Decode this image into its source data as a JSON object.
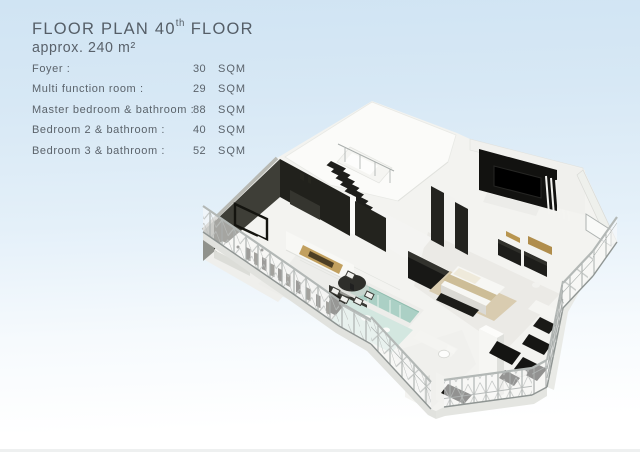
{
  "header": {
    "title_prefix": "FLOOR PLAN 40",
    "title_sup": "th",
    "title_suffix": " FLOOR",
    "subtitle": "approx. 240 m²"
  },
  "rooms": [
    {
      "label": "Foyer :",
      "value": "30",
      "unit": "SQM"
    },
    {
      "label": "Multi function room :",
      "value": "29",
      "unit": "SQM"
    },
    {
      "label": "Master bedroom & bathroom :",
      "value": "88",
      "unit": "SQM"
    },
    {
      "label": "Bedroom 2 & bathroom :",
      "value": "40",
      "unit": "SQM"
    },
    {
      "label": "Bedroom 3 & bathroom :",
      "value": "52",
      "unit": "SQM"
    }
  ],
  "palette": {
    "background_top": "#d2e5f3",
    "background_bottom": "#ffffff",
    "text_gray": "#5a626b",
    "plan_black": "#1a1a17",
    "plan_white": "#f5f5f2",
    "glass_green": "#a2ccbf",
    "wood_tan": "#c2a05f",
    "railing_gray": "#a9aeac"
  }
}
